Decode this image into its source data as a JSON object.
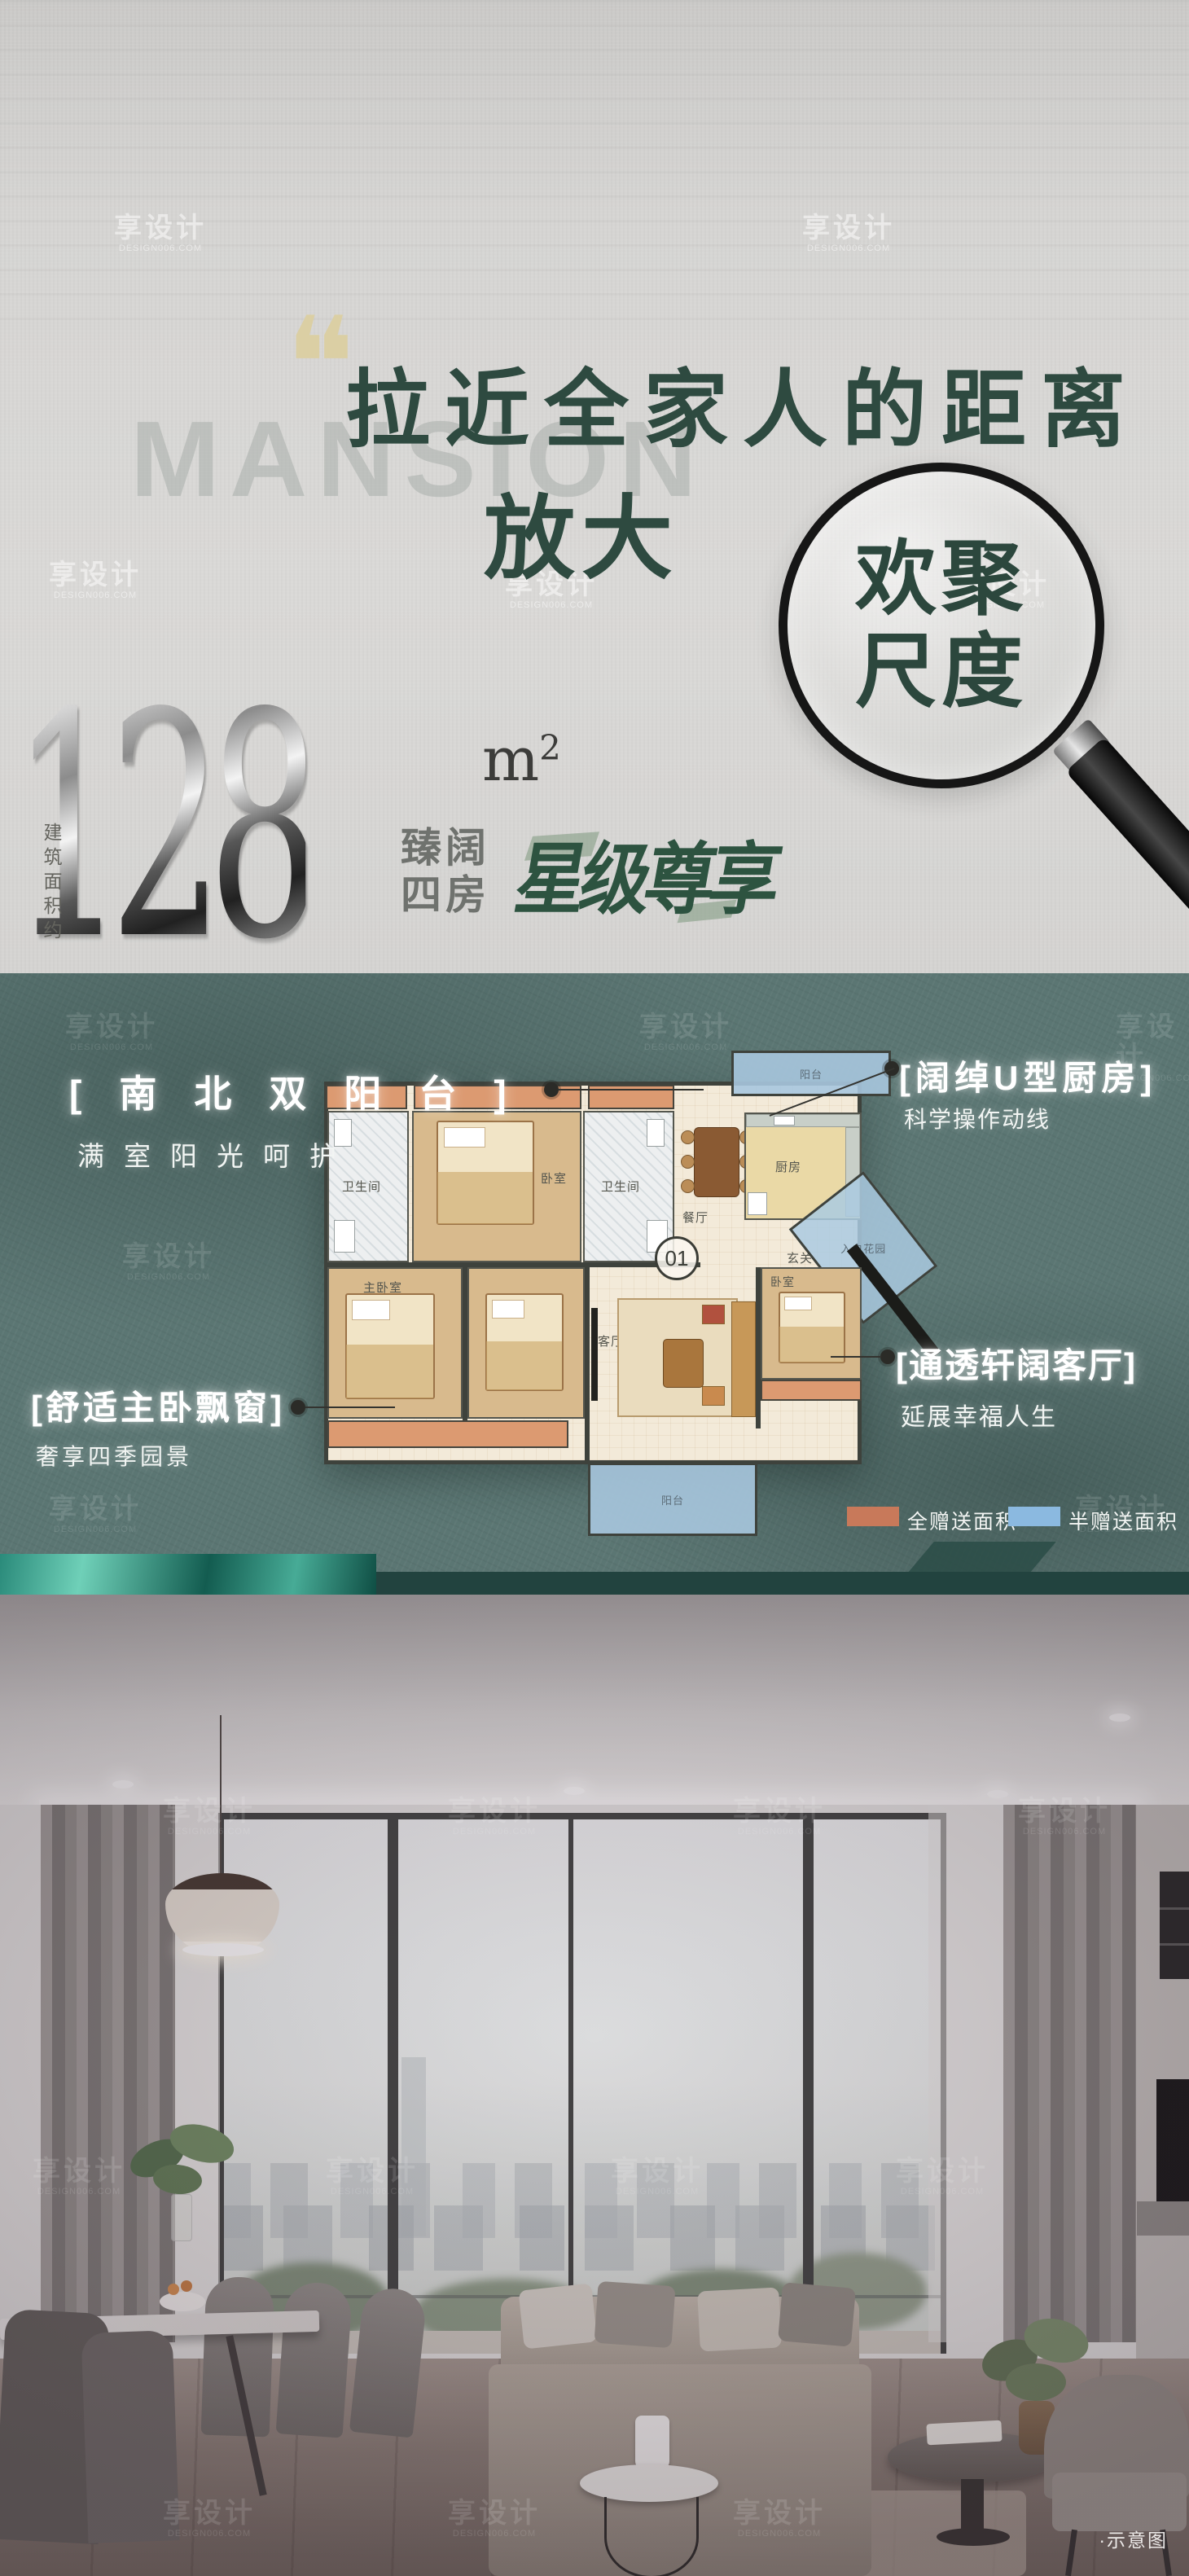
{
  "watermark": {
    "brand": "享设计",
    "domain": "DESIGN006.COM"
  },
  "hero": {
    "background_word": "MANSION",
    "quote_mark": "❝",
    "title": "拉近全家人的距离",
    "zoom_prefix": "放大",
    "lens_word_top": "欢聚",
    "lens_word_bottom": "尺度"
  },
  "area": {
    "value": "128",
    "unit": "m",
    "unit_exponent": "2",
    "build_note": "建筑面积约",
    "layout_line1": "臻阔",
    "layout_line2": "四房",
    "slogan": "星级尊享"
  },
  "floorplan": {
    "unit_number": "01",
    "rooms": [
      {
        "label": "卫生间"
      },
      {
        "label": "卧室"
      },
      {
        "label": "卫生间"
      },
      {
        "label": "阳台"
      },
      {
        "label": "厨房"
      },
      {
        "label": "餐厅"
      },
      {
        "label": "玄关"
      },
      {
        "label": "入户花园"
      },
      {
        "label": "主卧室"
      },
      {
        "label": "客厅"
      },
      {
        "label": "卧室"
      },
      {
        "label": "阳台"
      }
    ],
    "callouts": [
      {
        "title": "[南北双阳台]",
        "subtitle": "满室阳光呵护"
      },
      {
        "title": "[阔绰U型厨房]",
        "subtitle": "科学操作动线"
      },
      {
        "title": "[舒适主卧飘窗]",
        "subtitle": "奢享四季园景"
      },
      {
        "title": "[通透轩阔客厅]",
        "subtitle": "延展幸福人生"
      }
    ],
    "legend": [
      {
        "label": "全赠送面积",
        "color": "#c8795a"
      },
      {
        "label": "半赠送面积",
        "color": "#8bb9e0"
      }
    ]
  },
  "photo": {
    "caption": "·示意图"
  },
  "colors": {
    "title_green": "#2e4a40",
    "slogan_green": "#2d5340",
    "section_teal": "#5b7673",
    "legend_orange": "#c8795a",
    "legend_blue": "#8bb9e0",
    "accent_gold": "#dbcfa4"
  }
}
